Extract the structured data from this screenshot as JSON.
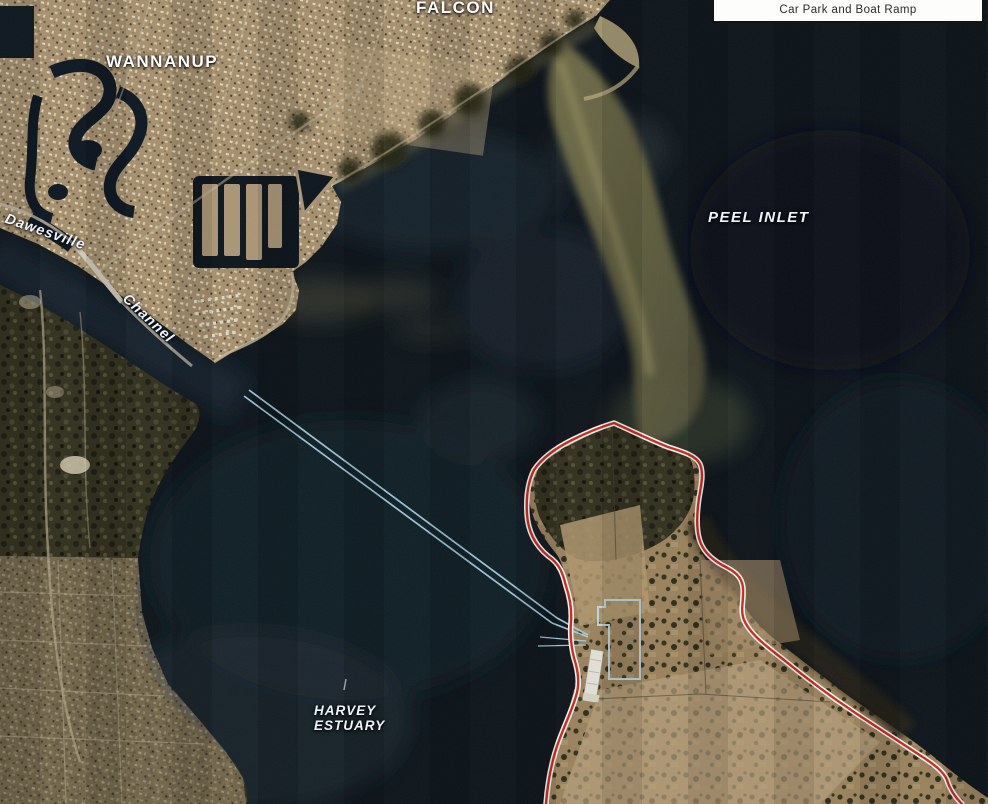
{
  "legend": {
    "box_label": "Car Park and Boat Ramp"
  },
  "labels": {
    "falcon": {
      "text": "FALCON"
    },
    "wannanup": {
      "text": "WANNANUP"
    },
    "peel_inlet": {
      "text": "PEEL INLET"
    },
    "dawesville": {
      "text": "Dawesville"
    },
    "channel": {
      "text": "Channel"
    },
    "harvey_estuary": {
      "line1": "HARVEY",
      "line2": "ESTUARY"
    }
  },
  "colors": {
    "project_boundary": "#d32b1c",
    "boundary_casing": "#ffffff",
    "navigation_channel": "#a9d7e6",
    "facility_outline": "#c2e2ee",
    "place_label": "#ffffff",
    "legend_background": "#fdfdfc",
    "legend_border": "#141414"
  }
}
